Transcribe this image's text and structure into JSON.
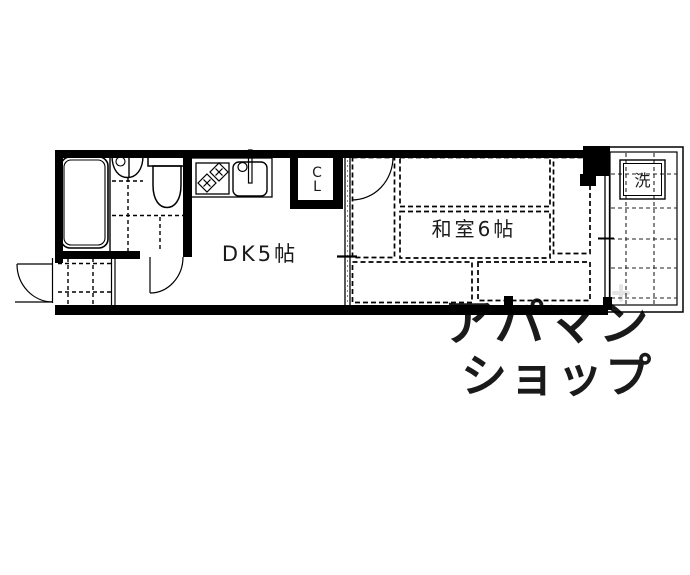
{
  "floorplan": {
    "labels": {
      "dk": "DK5帖",
      "washitsu": "和室6帖",
      "closet_top": "C",
      "closet_bottom": "L",
      "laundry": "洗"
    },
    "watermark": {
      "line1": "アパマン",
      "line2": "ショップ"
    },
    "colors": {
      "wall": "#000000",
      "line": "#000000",
      "watermark": "#e4e4e4",
      "background": "#ffffff"
    }
  }
}
